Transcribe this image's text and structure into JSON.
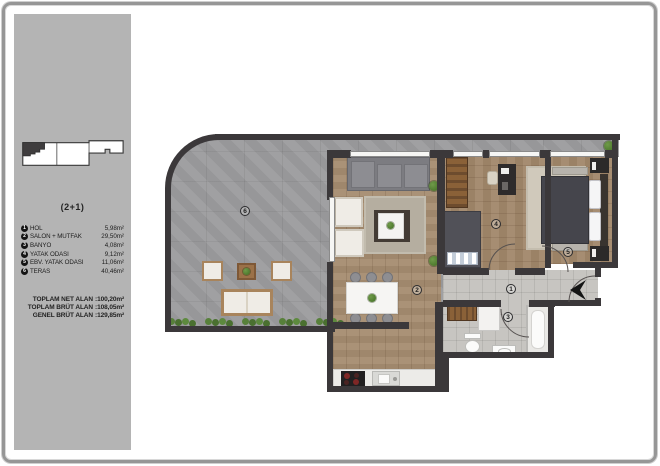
{
  "sidebar": {
    "unit_type": "(2+1)",
    "rooms": [
      {
        "num": "1",
        "name": "HOL",
        "area": "5,98m²"
      },
      {
        "num": "2",
        "name": "SALON + MUTFAK",
        "area": "29,50m²"
      },
      {
        "num": "3",
        "name": "BANYO",
        "area": "4,08m²"
      },
      {
        "num": "4",
        "name": "YATAK ODASI",
        "area": "9,12m²"
      },
      {
        "num": "5",
        "name": "EBV. YATAK ODASI",
        "area": "11,06m²"
      },
      {
        "num": "6",
        "name": "TERAS",
        "area": "40,46m²"
      }
    ],
    "totals": [
      {
        "label": "TOPLAM NET ALAN",
        "value": ":100,20m²"
      },
      {
        "label": "TOPLAM BRÜT ALAN",
        "value": ":108,05m²"
      },
      {
        "label": "GENEL BRÜT ALAN",
        "value": ":129,85m²"
      }
    ]
  },
  "colors": {
    "wall": "#3b383a",
    "terrace_tile": "#9c9c9e",
    "wood_floor": "#a58c70",
    "hall_tile": "#c7c5c1",
    "sidebar_bg": "#b4b4b4",
    "plant_green": "#57803a"
  }
}
